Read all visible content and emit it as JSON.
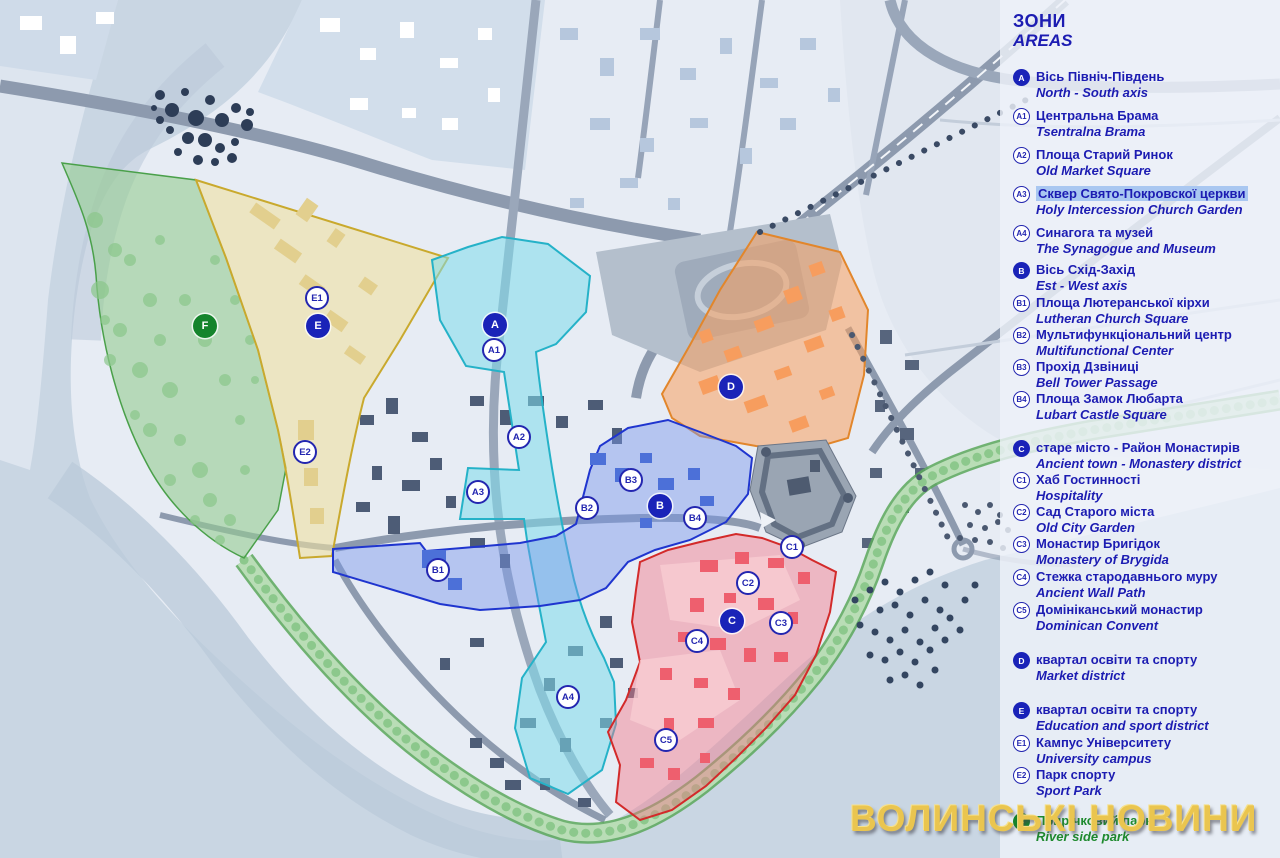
{
  "legend": {
    "title_uk": "ЗОНИ",
    "title_en": "AREAS",
    "items": [
      {
        "id": "A",
        "uk": "Вісь Північ-Південь",
        "en": "North - South axis",
        "kind": "filled"
      },
      {
        "id": "A1",
        "uk": "Центральна Брама",
        "en": "Tsentralna Brama",
        "kind": "outline"
      },
      {
        "id": "A2",
        "uk": "Площа Старий Ринок",
        "en": "Old Market Square",
        "kind": "outline"
      },
      {
        "id": "A3",
        "uk": "Сквер Свято-Покровскої церкви",
        "en": "Holy Intercession Church Garden",
        "kind": "outline",
        "highlight": true
      },
      {
        "id": "A4",
        "uk": "Синагога та музей",
        "en": "The Synagogue and Museum",
        "kind": "outline"
      },
      {
        "id": "B",
        "uk": "Вісь Схід-Захід",
        "en": "Est - West axis",
        "kind": "filled"
      },
      {
        "id": "B1",
        "uk": "Площа Лютеранської кірхи",
        "en": "Lutheran Church Square",
        "kind": "outline"
      },
      {
        "id": "B2",
        "uk": "Мультифункціональний центр",
        "en": "Multifunctional Center",
        "kind": "outline"
      },
      {
        "id": "B3",
        "uk": "Прохід Дзвіниці",
        "en": "Bell Tower Passage",
        "kind": "outline"
      },
      {
        "id": "B4",
        "uk": "Площа Замок Любарта",
        "en": "Lubart Castle Square",
        "kind": "outline"
      },
      {
        "id": "C",
        "uk": "старе місто - Район Монастирів",
        "en": "Ancient town - Monastery district",
        "kind": "filled"
      },
      {
        "id": "C1",
        "uk": "Хаб Гостинності",
        "en": "Hospitality",
        "kind": "outline"
      },
      {
        "id": "C2",
        "uk": "Сад Старого міста",
        "en": "Old City Garden",
        "kind": "outline"
      },
      {
        "id": "C3",
        "uk": "Монастир Бригідок",
        "en": "Monastery of Brygida",
        "kind": "outline"
      },
      {
        "id": "C4",
        "uk": "Стежка стародавнього муру",
        "en": "Ancient Wall Path",
        "kind": "outline"
      },
      {
        "id": "C5",
        "uk": "Домініканський монастир",
        "en": "Dominican Convent",
        "kind": "outline"
      },
      {
        "id": "D",
        "uk": "квартал освіти та спорту",
        "en": "Market district",
        "kind": "filled"
      },
      {
        "id": "E",
        "uk": "квартал освіти та спорту",
        "en": "Education and sport district",
        "kind": "filled"
      },
      {
        "id": "E1",
        "uk": "Кампус Університету",
        "en": "University campus",
        "kind": "outline"
      },
      {
        "id": "E2",
        "uk": "Парк спорту",
        "en": "Sport Park",
        "kind": "outline"
      },
      {
        "id": "F",
        "uk": "Прирічковий парк",
        "en": "River side park",
        "kind": "green"
      }
    ]
  },
  "map": {
    "markers": {
      "A": "A",
      "A1": "A1",
      "A2": "A2",
      "A3": "A3",
      "A4": "A4",
      "B": "B",
      "B1": "B1",
      "B2": "B2",
      "B3": "B3",
      "B4": "B4",
      "C": "C",
      "C1": "C1",
      "C2": "C2",
      "C3": "C3",
      "C4": "C4",
      "C5": "C5",
      "D": "D",
      "E": "E",
      "E1": "E1",
      "E2": "E2",
      "F": "F"
    }
  },
  "watermark": {
    "text": "ВОЛИНСЬКІ НОВИНИ"
  },
  "colors": {
    "legend_blue": "#1c1cb2",
    "highlight": "#a9c7f1",
    "gold": "#eac54f",
    "green_text": "#1e8a2e",
    "zone_a": "#7ddcec",
    "zone_b": "#7896eb",
    "zone_c": "#f4788a",
    "zone_d": "#fa9f5f",
    "zone_e": "#f0e1a0",
    "zone_f": "#96cd91",
    "water": "#c9d6e3",
    "land": "#e7ecf4"
  }
}
